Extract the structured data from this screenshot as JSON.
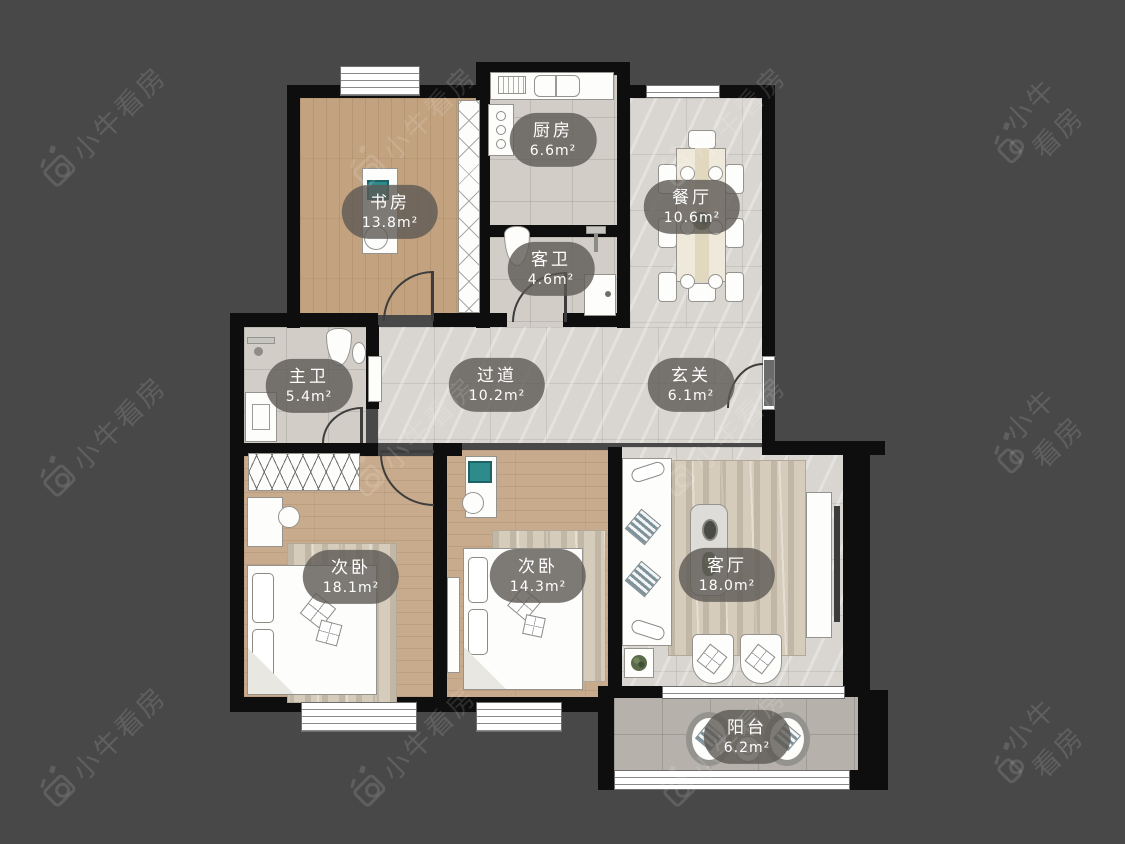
{
  "canvas": {
    "width": 1125,
    "height": 844,
    "background": "#484848"
  },
  "watermark": {
    "brand": "小牛看房",
    "icon": "bull-camera-logo",
    "color": "rgba(255,255,255,0.13)"
  },
  "rooms": [
    {
      "id": "study",
      "name": "书房",
      "area": "13.8m²"
    },
    {
      "id": "kitchen",
      "name": "厨房",
      "area": "6.6m²"
    },
    {
      "id": "dining",
      "name": "餐厅",
      "area": "10.6m²"
    },
    {
      "id": "guest_bath",
      "name": "客卫",
      "area": "4.6m²"
    },
    {
      "id": "master_bath",
      "name": "主卫",
      "area": "5.4m²"
    },
    {
      "id": "hallway",
      "name": "过道",
      "area": "10.2m²"
    },
    {
      "id": "entry",
      "name": "玄关",
      "area": "6.1m²"
    },
    {
      "id": "bedroom_a",
      "name": "次卧",
      "area": "18.1m²"
    },
    {
      "id": "bedroom_b",
      "name": "次卧",
      "area": "14.3m²"
    },
    {
      "id": "living",
      "name": "客厅",
      "area": "18.0m²"
    },
    {
      "id": "balcony",
      "name": "阳台",
      "area": "6.2m²"
    }
  ],
  "colors": {
    "wall": "#0e0e0e",
    "wood": "#c6a988",
    "tile": "#d2cec7",
    "marble": "#d9d6d1",
    "balcony_tile": "#b6b2ab",
    "label_bg": "rgba(92,89,84,0.8)",
    "label_text": "#ffffff",
    "accent_teal": "#2e8b8c"
  }
}
